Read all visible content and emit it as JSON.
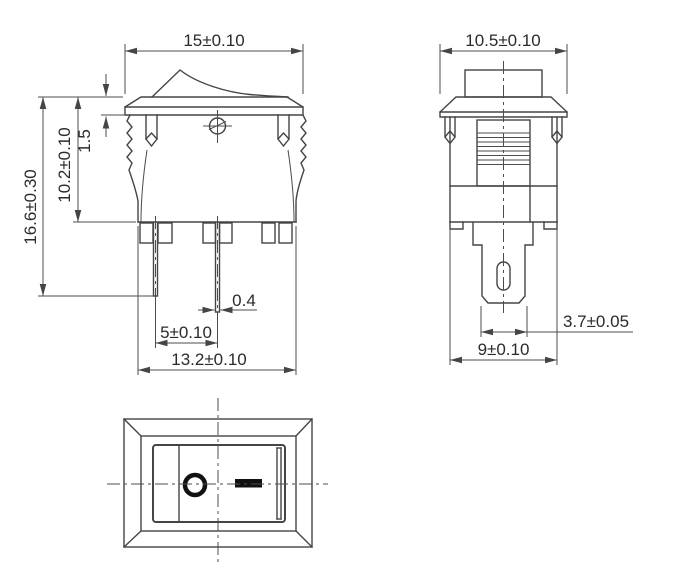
{
  "colors": {
    "background": "#ffffff",
    "line": "#454545",
    "text": "#2b2b2b",
    "symbol": "#111111"
  },
  "front_view": {
    "flange_width": "15±0.10",
    "total_height": "16.6±0.30",
    "body_height": "10.2±0.10",
    "flange_thickness": "1.5",
    "terminal_thickness": "0.4",
    "terminal_pitch": "5±0.10",
    "body_width": "13.2±0.10"
  },
  "side_view": {
    "flange_depth": "10.5±0.10",
    "terminal_width": "3.7±0.05",
    "body_depth": "9±0.10"
  },
  "bottom_view": {
    "off_symbol": "O",
    "on_symbol": "—"
  }
}
